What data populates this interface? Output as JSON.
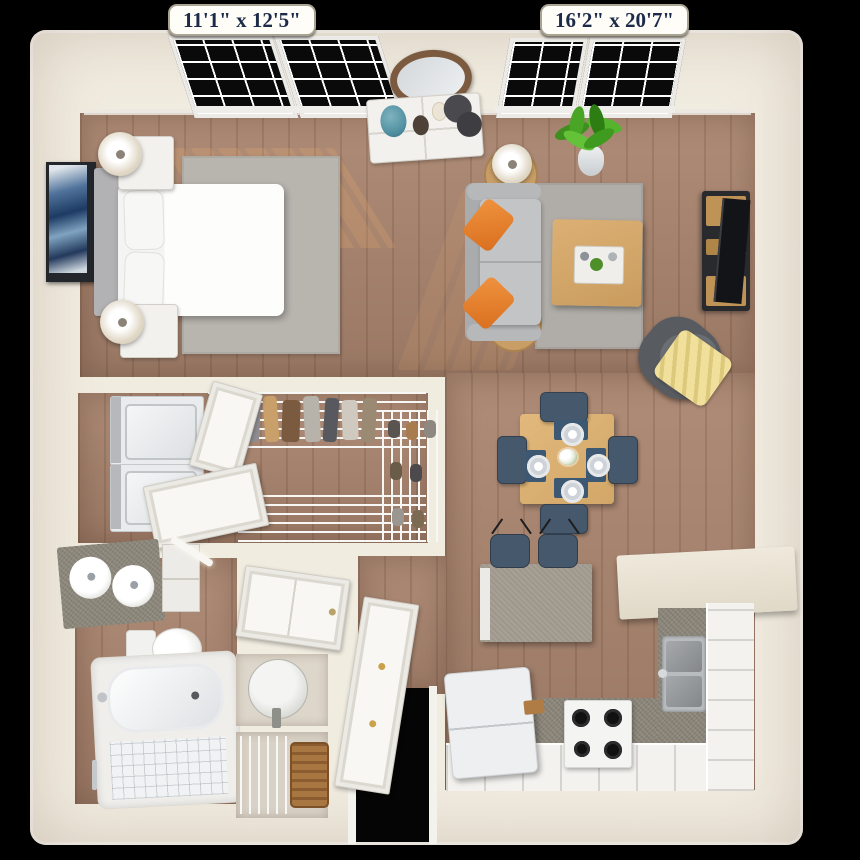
{
  "page": {
    "type": "3d-floor-plan-render",
    "description": "top-down 3d rendering of a one-bedroom apartment"
  },
  "dimension_labels": {
    "bedroom": "11'1\" x 12'5\"",
    "living_room": "16'2\" x 20'7\""
  },
  "palette": {
    "background": "#000000",
    "walls": "#f1ece0",
    "wood_floor": "#a5816c",
    "rug_gray": "#b8b5af",
    "sofa_gray": "#b9bbbd",
    "pillow_orange": "#e07c2b",
    "chair_navy": "#46586b",
    "table_wood": "#ddb275",
    "counter_gray": "#8a8478",
    "throw_yellow": "#ecd98c",
    "plant_green": "#4da32a",
    "vase_teal": "#4f8fa0",
    "label_text": "#1c2b4a"
  },
  "rooms": [
    {
      "name": "bedroom",
      "furniture": [
        "queen-bed",
        "gray-headboard",
        "two-nightstands",
        "two-table-lamps",
        "gray-area-rug",
        "blue-wall-art",
        "double-window"
      ]
    },
    {
      "name": "living-room",
      "furniture": [
        "gray-sofa",
        "two-orange-pillows",
        "wood-coffee-table",
        "tv-console",
        "flat-tv",
        "dark-accent-chair",
        "yellow-throw",
        "two-round-side-tables",
        "two-lamps",
        "gray-area-rug",
        "potted-plant",
        "double-window",
        "white-dresser",
        "oval-wall-mirror"
      ]
    },
    {
      "name": "dining-area",
      "furniture": [
        "square-wood-table",
        "four-navy-chairs",
        "four-place-settings",
        "flower-centerpiece"
      ]
    },
    {
      "name": "kitchen",
      "furniture": [
        "gray-top-island",
        "two-navy-bar-stools",
        "refrigerator",
        "white-range-four-burners",
        "stainless-double-sink",
        "l-shaped-white-counter",
        "breakfast-bar"
      ]
    },
    {
      "name": "walk-in-closet",
      "furniture": [
        "stacked-washer-dryer",
        "wire-shelving-with-clothes",
        "lower-wire-shelf",
        "shoe-rack",
        "two-closet-doors"
      ]
    },
    {
      "name": "bathroom",
      "furniture": [
        "double-sink-vanity",
        "mirror-cabinet",
        "vanity-light",
        "toilet",
        "tub-shower-combo",
        "towel-bar"
      ]
    },
    {
      "name": "utility-closets",
      "furniture": [
        "linen-closet-door",
        "water-heater",
        "wire-shelf-with-basket"
      ]
    },
    {
      "name": "entry",
      "furniture": [
        "entry-door-ajar",
        "door-opening"
      ]
    }
  ]
}
